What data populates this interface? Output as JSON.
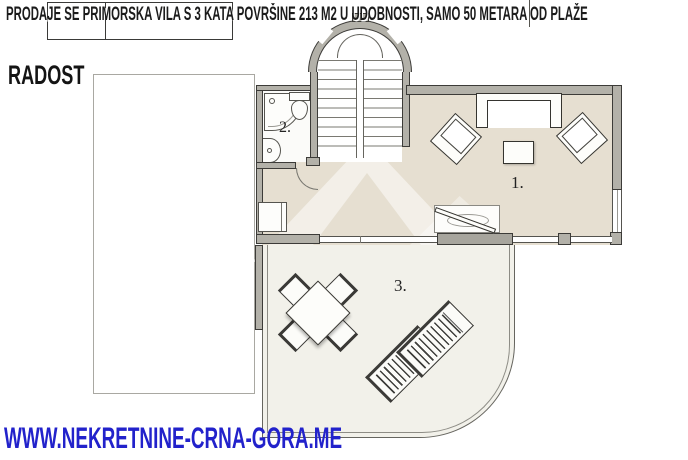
{
  "banner": {
    "text": "PRODAJE SE PRIMORSKA VILA S 3 KATA POVRŠINE 213 M2 U UDOBNOSTI, SAMO 50 METARA OD PLAŽE"
  },
  "brand": {
    "name": "RADOST"
  },
  "footer": {
    "website": "WWW.NEKRETNINE-CRNA-GORA.ME"
  },
  "floorplan": {
    "room_labels": {
      "living_room": "1.",
      "bathroom": "2.",
      "terrace": "3."
    },
    "colors": {
      "wall_gray": "#b3b1a9",
      "outline_dark": "#3c3b38",
      "floor_beige": "#e6dfd1",
      "terrace_cream": "#f2f1ea",
      "url_blue": "#2222cb"
    }
  }
}
